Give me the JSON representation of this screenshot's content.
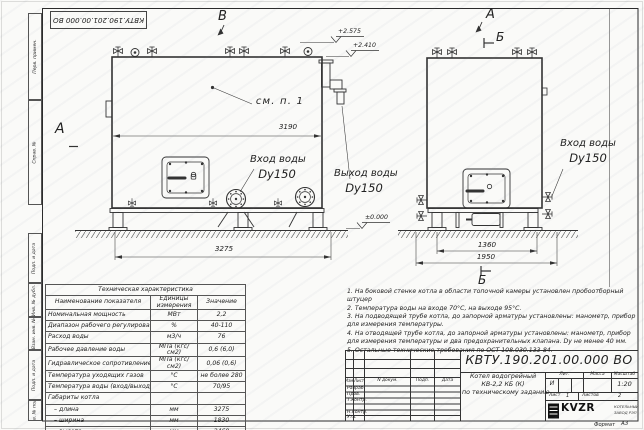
{
  "doc": {
    "number": "КВТУ.190.201.00.000 ВО",
    "format_label": "Формат",
    "format_value": "А3"
  },
  "margin_labels": [
    "Перв. примен.",
    "Справ. №",
    "Подп. и дата",
    "Инв. № дубл.",
    "Взам. инв. №",
    "Подп. и дата",
    "Инв. № подл."
  ],
  "views": {
    "front": {
      "view_label": "А",
      "top_view_label": "В",
      "see_note": "см. п. 1",
      "dim_inner": "3190",
      "dim_total": "3275",
      "inlet_label": "Вход воды",
      "inlet_dn": "Dy150",
      "outlet_label": "Выход воды",
      "outlet_dn": "Dy150",
      "elev_top": "+2.575",
      "elev_mid": "+2.410",
      "elev_zero": "±0.000"
    },
    "side": {
      "view_label": "А",
      "section_label_top": "Б",
      "section_label_bottom": "Б",
      "inlet_label": "Вход воды",
      "inlet_dn": "Dy150",
      "dim_inner": "1360",
      "dim_total": "1950"
    }
  },
  "specs_table": {
    "title": "Техническая характеристика",
    "col_headers": [
      "Наименование показателя",
      "Единицы измерения",
      "Значение"
    ],
    "rows": [
      [
        "Номинальная мощность",
        "МВт",
        "2,2"
      ],
      [
        "Диапазон рабочего регулирования",
        "%",
        "40-110"
      ],
      [
        "Расход воды",
        "м3/ч",
        "76"
      ],
      [
        "Рабочее давление воды",
        "МПа (кгс/см2)",
        "0,6 (6,0)"
      ],
      [
        "Гидравлическое сопротивление котла",
        "МПа (кгс/см2)",
        "0,06 (0,6)"
      ],
      [
        "Температура уходящих газов",
        "°С",
        "не более 280"
      ],
      [
        "Температура воды (вход/выход)",
        "°С",
        "70/95"
      ],
      [
        "Габариты котла",
        "",
        ""
      ],
      [
        "– длина",
        "мм",
        "3275"
      ],
      [
        "– ширина",
        "мм",
        "1830"
      ],
      [
        "– высота",
        "мм",
        "2460"
      ]
    ]
  },
  "notes": {
    "items": [
      "1.  На боковой стенке котла в области топочной камеры установлен пробоотборный штуцер",
      "2.  Температура воды на входе 70°С, на выходе 95°С.",
      "3.  На подводящей трубе котла, до запорной арматуры установлены: манометр, прибор для измерения температуры.",
      "4.  На отводящей трубе котла, до запорной арматуры установлены: манометр, прибор для измерения температуры и два предохранительных клапана. Dу не менее 40 мм.",
      "5.  Остальные технические требования по ОСТ 108.030.133-84."
    ]
  },
  "title_block": {
    "rev_headers": [
      "Изм.",
      "Лист",
      "N докум.",
      "Подп.",
      "Дата"
    ],
    "sign_rows": [
      "Разраб.",
      "Пров.",
      "Т.контр.",
      "Н.контр.",
      "Утв."
    ],
    "product_lines": [
      "Котел водогрейный",
      "КВ-2,2 КБ (К)",
      "по техническому заданию"
    ],
    "lit_header": "Лит.",
    "mass_header": "Масса",
    "scale_header": "Масштаб",
    "lit_value": "И",
    "scale_value": "1:20",
    "sheet_label": "Лист",
    "sheet_value": "1",
    "sheets_label": "Листов",
    "sheets_value": "2",
    "company": {
      "logo": "KVZR",
      "name_line1": "КОТЕЛЬНЫЙ",
      "name_line2": "ЗАВОД РЭП"
    }
  }
}
